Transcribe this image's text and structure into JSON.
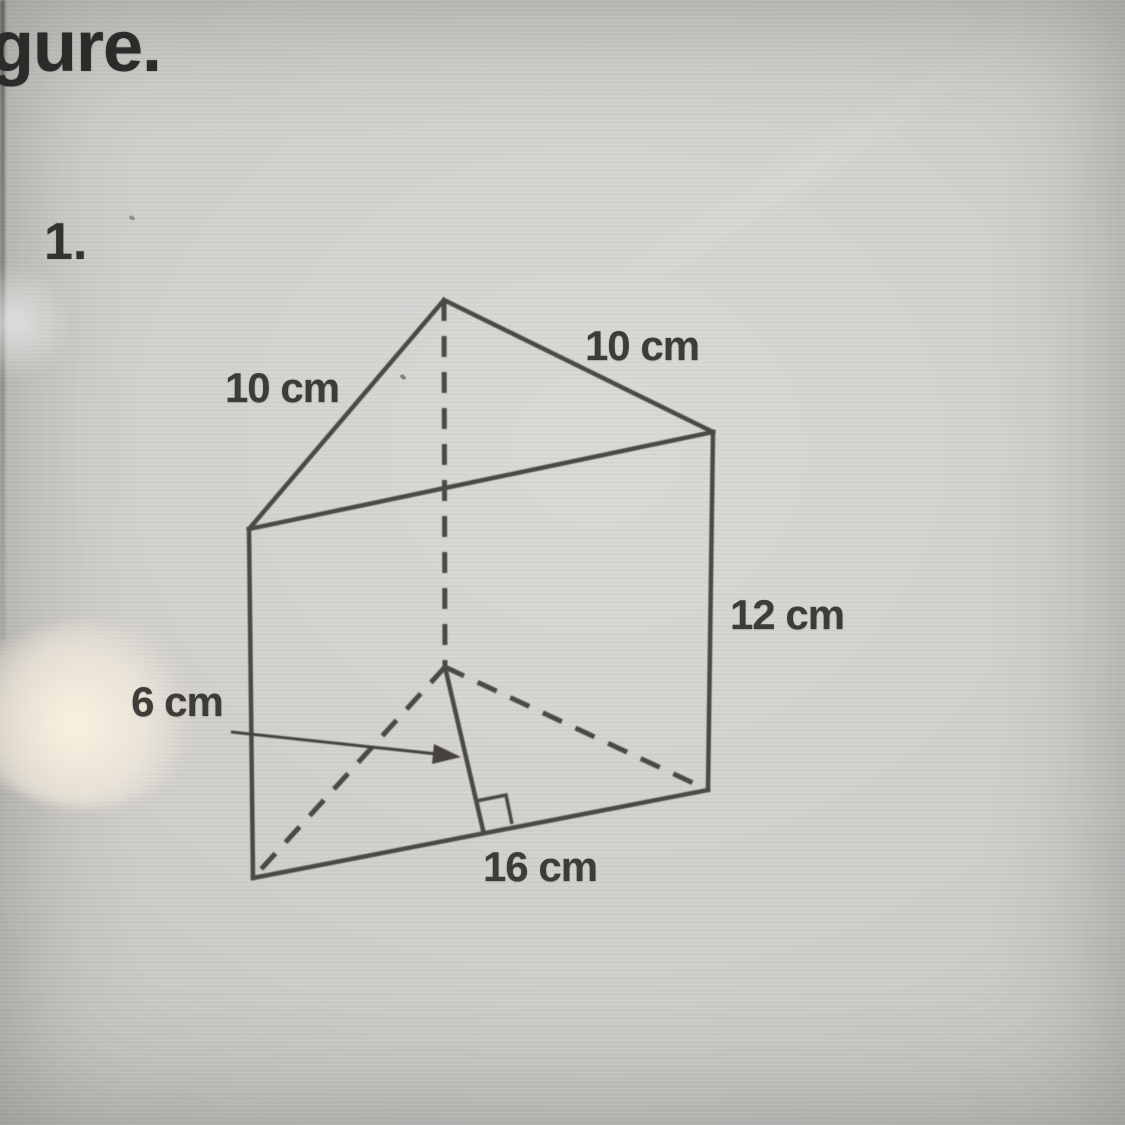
{
  "page": {
    "heading_partial": "gure.",
    "problem_number": "1."
  },
  "figure_labels": {
    "top_left_edge": "10 cm",
    "top_right_edge": "10 cm",
    "prism_height": "12 cm",
    "triangle_height": "6 cm",
    "base_edge": "16 cm"
  },
  "diagram": {
    "shape": "triangular-prism",
    "stroke_color": "#4c4a47",
    "arrow_color": "#45433f",
    "vertices": {
      "apex_top": [
        444,
        300
      ],
      "front_top_left": [
        249,
        529
      ],
      "front_top_right": [
        713,
        432
      ],
      "front_bottom_left": [
        253,
        878
      ],
      "front_bottom_right": [
        708,
        790
      ],
      "base_back": [
        445,
        667
      ],
      "height_foot": [
        483,
        830
      ]
    },
    "solid_edges": [
      [
        "apex_top",
        "front_top_left"
      ],
      [
        "apex_top",
        "front_top_right"
      ],
      [
        "front_top_left",
        "front_top_right"
      ],
      [
        "front_top_left",
        "front_bottom_left"
      ],
      [
        "front_top_right",
        "front_bottom_right"
      ],
      [
        "front_bottom_left",
        "front_bottom_right"
      ],
      [
        "base_back",
        "height_foot"
      ]
    ],
    "dashed_edges": [
      [
        "apex_top",
        "base_back"
      ],
      [
        "base_back",
        "front_bottom_left"
      ],
      [
        "base_back",
        "front_bottom_right"
      ]
    ],
    "right_angle_marker": [
      [
        512,
        824
      ],
      [
        506,
        795
      ],
      [
        476,
        801
      ]
    ],
    "arrow": {
      "line": [
        [
          231,
          732
        ],
        [
          437,
          754
        ]
      ],
      "head": [
        [
          461,
          757
        ],
        [
          432,
          764
        ],
        [
          434,
          744
        ]
      ]
    }
  }
}
